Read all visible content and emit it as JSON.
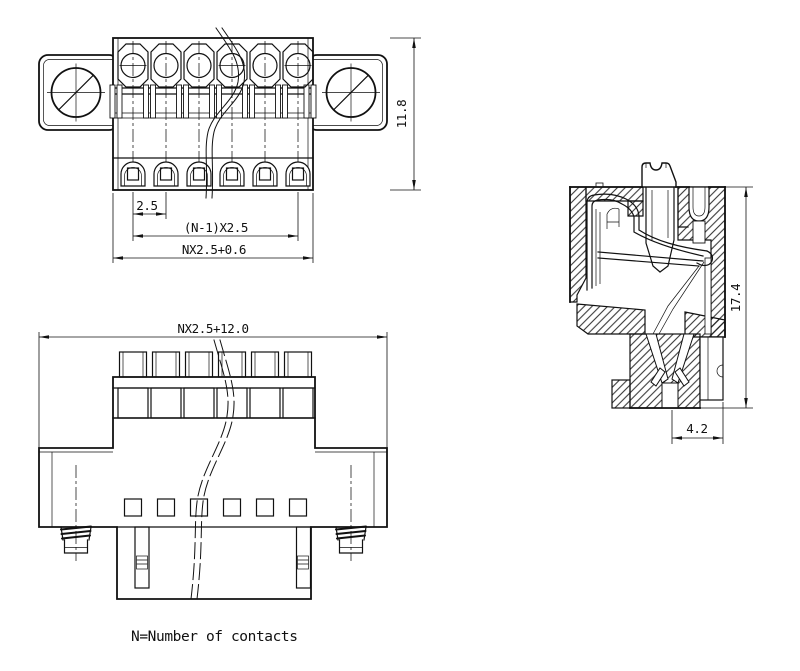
{
  "drawing": {
    "background": "#ffffff",
    "line_color": "#111111",
    "note": "N=Number of contacts",
    "front_view": {
      "contacts_shown": 6,
      "dim_pitch": "2.5",
      "dim_span": "(N-1)X2.5",
      "dim_width": "NX2.5+0.6",
      "dim_height": "11.8"
    },
    "plug_view": {
      "dim_width": "NX2.5+12.0"
    },
    "section_view": {
      "dim_height": "17.4",
      "dim_depth": "4.2"
    }
  }
}
